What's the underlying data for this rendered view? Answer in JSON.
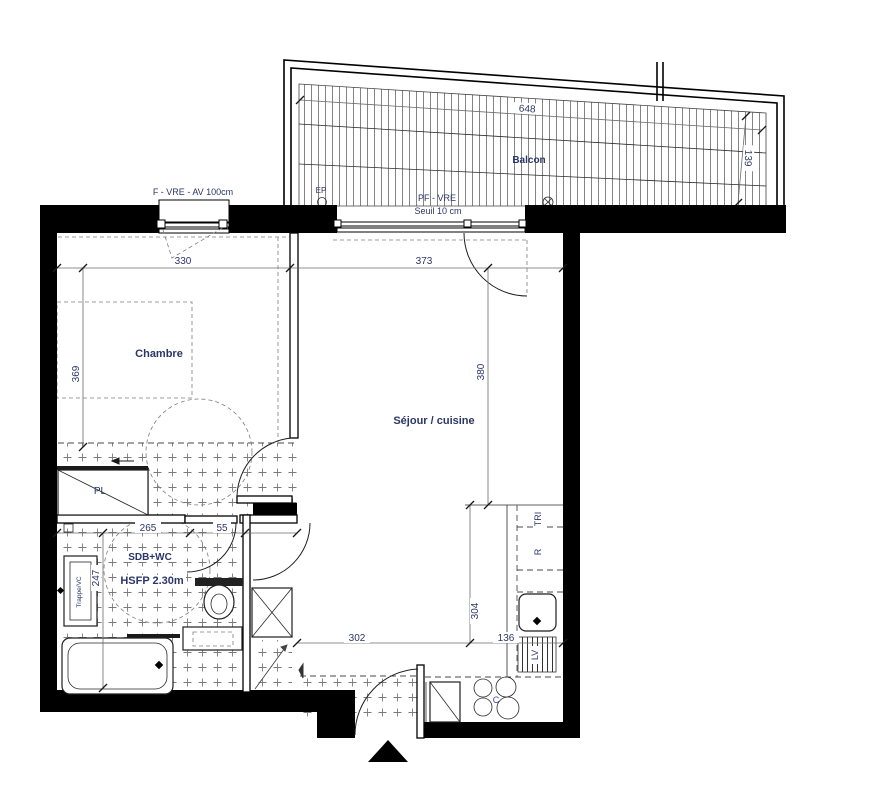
{
  "plan_title": "Apartment floor plan",
  "rooms": {
    "balcony": "Balcon",
    "bedroom": "Chambre",
    "living_kitchen": "Séjour / cuisine",
    "bathroom": "SDB+WC",
    "ceiling_height": "HSFP 2.30m"
  },
  "fixtures": {
    "closet": "PL",
    "bath_screen": "PB",
    "recycling": "TRI",
    "fridge": "R",
    "dishwasher": "LV",
    "cooktop": "C",
    "rain_pipe": "EP",
    "access_hatch": "Trappe/VC"
  },
  "windows": {
    "bedroom_window": "F - VRE - AV 100cm",
    "balcony_door": "PF - VRE",
    "threshold": "Seuil 10 cm"
  },
  "dimensions": {
    "balcony_width": "648",
    "balcony_depth": "139",
    "bedroom_width": "330",
    "living_width": "373",
    "bedroom_depth": "369",
    "living_depth": "380",
    "bath_width": "265",
    "bath_door": "55",
    "bath_depth": "247",
    "entry_width": "302",
    "kitchen_run": "304",
    "kitchen_return": "136"
  },
  "colors": {
    "wall": "#000000",
    "text": "#2b3668",
    "hatch": "#7a7a7a"
  }
}
